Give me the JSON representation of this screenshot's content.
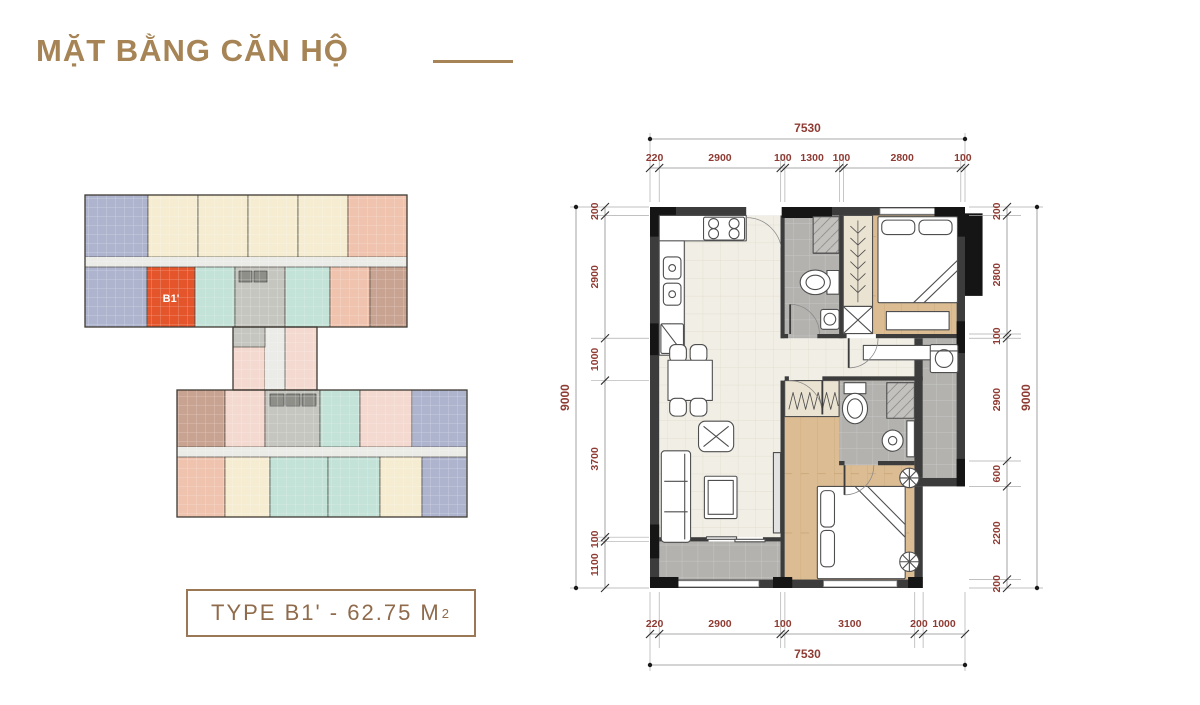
{
  "header": {
    "title": "MẶT BẰNG CĂN HỘ",
    "accent_color": "#A68455"
  },
  "type_badge": {
    "label": "TYPE B1' - 62.75 M",
    "superscript": "2"
  },
  "keymap": {
    "highlight": {
      "label": "B1'",
      "color": "#E4552B",
      "text_color": "#FFFFFF"
    },
    "palette": {
      "blue": "#AEB4CE",
      "cream": "#F5ECD2",
      "salmon": "#EFC3AE",
      "teal": "#C3E2D8",
      "brown": "#C9A392",
      "pink": "#F3D9CF",
      "core": "#C6C6C0",
      "lift": "#8F8F8A",
      "corridor": "#EBEBE8",
      "highlight": "#E4552B",
      "outline": "#4B463F"
    },
    "blocks": [
      {
        "x": 15,
        "y": 15,
        "w": 63,
        "h": 62,
        "c": "blue"
      },
      {
        "x": 78,
        "y": 15,
        "w": 50,
        "h": 62,
        "c": "cream"
      },
      {
        "x": 128,
        "y": 15,
        "w": 50,
        "h": 62,
        "c": "cream"
      },
      {
        "x": 178,
        "y": 15,
        "w": 50,
        "h": 62,
        "c": "cream"
      },
      {
        "x": 228,
        "y": 15,
        "w": 50,
        "h": 62,
        "c": "cream"
      },
      {
        "x": 278,
        "y": 15,
        "w": 59,
        "h": 62,
        "c": "salmon"
      },
      {
        "x": 15,
        "y": 77,
        "w": 322,
        "h": 10,
        "c": "corridor"
      },
      {
        "x": 15,
        "y": 87,
        "w": 62,
        "h": 60,
        "c": "blue"
      },
      {
        "x": 77,
        "y": 87,
        "w": 48,
        "h": 60,
        "c": "highlight"
      },
      {
        "x": 125,
        "y": 87,
        "w": 40,
        "h": 60,
        "c": "teal"
      },
      {
        "x": 165,
        "y": 87,
        "w": 50,
        "h": 60,
        "c": "core"
      },
      {
        "x": 169,
        "y": 91,
        "w": 13,
        "h": 11,
        "c": "lift"
      },
      {
        "x": 184,
        "y": 91,
        "w": 13,
        "h": 11,
        "c": "lift"
      },
      {
        "x": 215,
        "y": 87,
        "w": 45,
        "h": 60,
        "c": "teal"
      },
      {
        "x": 260,
        "y": 87,
        "w": 40,
        "h": 60,
        "c": "salmon"
      },
      {
        "x": 300,
        "y": 87,
        "w": 37,
        "h": 60,
        "c": "brown"
      },
      {
        "x": 163,
        "y": 147,
        "w": 32,
        "h": 63,
        "c": "pink"
      },
      {
        "x": 195,
        "y": 147,
        "w": 20,
        "h": 63,
        "c": "corridor"
      },
      {
        "x": 215,
        "y": 147,
        "w": 32,
        "h": 63,
        "c": "pink"
      },
      {
        "x": 163,
        "y": 147,
        "w": 32,
        "h": 20,
        "c": "core"
      },
      {
        "x": 107,
        "y": 210,
        "w": 48,
        "h": 57,
        "c": "brown"
      },
      {
        "x": 155,
        "y": 210,
        "w": 40,
        "h": 57,
        "c": "pink"
      },
      {
        "x": 195,
        "y": 210,
        "w": 55,
        "h": 57,
        "c": "core"
      },
      {
        "x": 200,
        "y": 214,
        "w": 14,
        "h": 12,
        "c": "lift"
      },
      {
        "x": 216,
        "y": 214,
        "w": 14,
        "h": 12,
        "c": "lift"
      },
      {
        "x": 232,
        "y": 214,
        "w": 14,
        "h": 12,
        "c": "lift"
      },
      {
        "x": 250,
        "y": 210,
        "w": 40,
        "h": 57,
        "c": "teal"
      },
      {
        "x": 290,
        "y": 210,
        "w": 52,
        "h": 57,
        "c": "pink"
      },
      {
        "x": 342,
        "y": 210,
        "w": 55,
        "h": 57,
        "c": "blue"
      },
      {
        "x": 107,
        "y": 267,
        "w": 290,
        "h": 10,
        "c": "corridor"
      },
      {
        "x": 107,
        "y": 277,
        "w": 48,
        "h": 60,
        "c": "salmon"
      },
      {
        "x": 155,
        "y": 277,
        "w": 45,
        "h": 60,
        "c": "cream"
      },
      {
        "x": 200,
        "y": 277,
        "w": 58,
        "h": 60,
        "c": "teal"
      },
      {
        "x": 258,
        "y": 277,
        "w": 52,
        "h": 60,
        "c": "teal"
      },
      {
        "x": 310,
        "y": 277,
        "w": 42,
        "h": 60,
        "c": "cream"
      },
      {
        "x": 352,
        "y": 277,
        "w": 45,
        "h": 60,
        "c": "blue"
      }
    ],
    "outlines": [
      {
        "x": 15,
        "y": 15,
        "w": 322,
        "h": 132
      },
      {
        "x": 163,
        "y": 147,
        "w": 84,
        "h": 63
      },
      {
        "x": 107,
        "y": 210,
        "w": 290,
        "h": 127
      }
    ]
  },
  "plan": {
    "dimension_color": "#8E3B33",
    "line_color": "#8C8C8C",
    "dimensions": {
      "top": {
        "total": "7530",
        "segments": [
          220,
          2900,
          100,
          1300,
          100,
          2800,
          100
        ]
      },
      "bottom": {
        "total": "7530",
        "segments": [
          220,
          2900,
          100,
          3100,
          200,
          1000
        ]
      },
      "left": {
        "total": "9000",
        "segments": [
          200,
          2900,
          1000,
          3700,
          100,
          1100
        ]
      },
      "right": {
        "total": "9000",
        "segments": [
          200,
          2800,
          100,
          2900,
          600,
          2200,
          200
        ]
      }
    },
    "floors": {
      "living": "#F1EEE6",
      "wood": "#DCBD93",
      "tile": "#B3B2AF",
      "wardrobe": "#EBE3D1",
      "wall": "#3C3C3C",
      "column": "#151515"
    }
  }
}
